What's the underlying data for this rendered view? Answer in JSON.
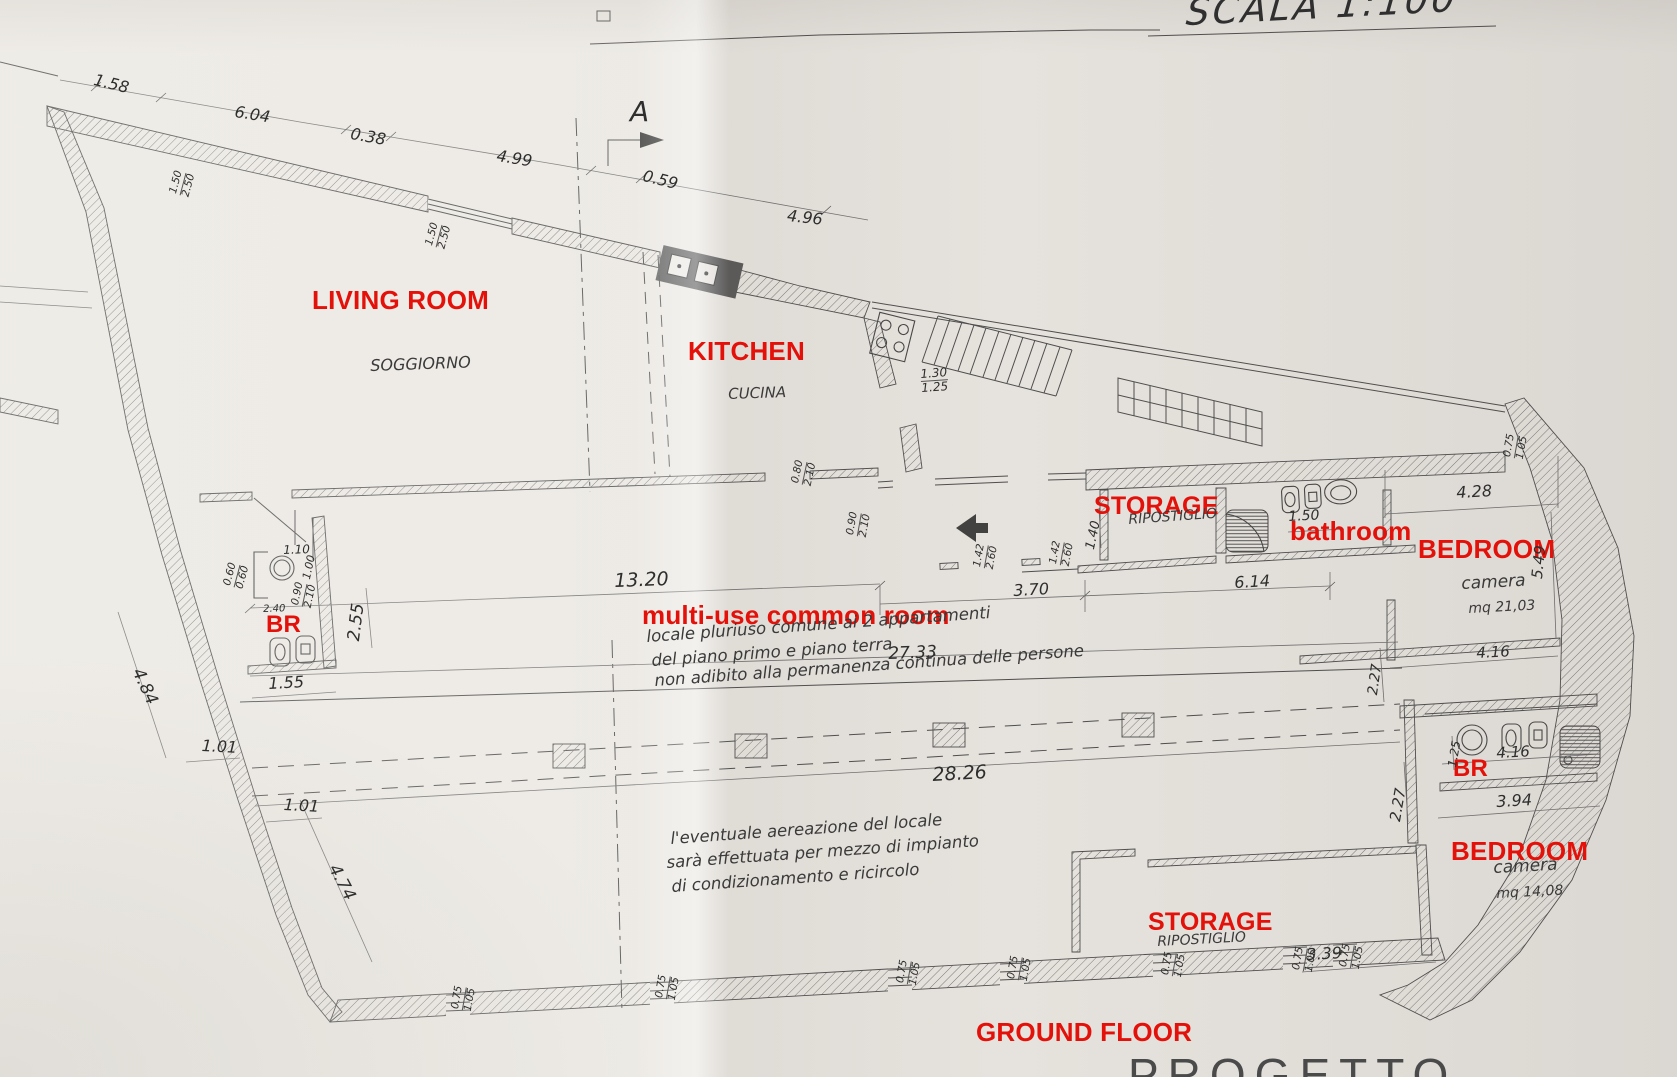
{
  "scale_note": "SCALA 1:100",
  "section_marker": "A",
  "floor_label": "GROUND FLOOR",
  "title_partial": "PROGETTO",
  "colors": {
    "annotation_red": "#e31109",
    "ink": "#3c3c3c",
    "paper": "#eae7e2"
  },
  "rooms": {
    "living_room_en": "LIVING ROOM",
    "living_room_it": "SOGGIORNO",
    "kitchen_en": "KITCHEN",
    "kitchen_it": "CUCINA",
    "storage_en": "STORAGE",
    "storage_it": "RIPOSTIGLIO",
    "bathroom_en": "bathroom",
    "bedroom_en": "BEDROOM",
    "bedroom1_it": "camera",
    "bedroom1_area": "mq 21,03",
    "bedroom2_it": "camera",
    "bedroom2_area": "mq 14,08",
    "br": "BR",
    "multi_use_en": "multi-use common room"
  },
  "notes": {
    "multi_use_1": "locale pluriuso comune ai 2 appartamenti",
    "multi_use_2": "del piano primo e piano terra",
    "multi_use_3": "non adibito alla permanenza continua delle persone",
    "aeration_1": "l'eventuale aereazione del locale",
    "aeration_2": "sarà effettuata per mezzo di impianto",
    "aeration_3": "di condizionamento e ricircolo"
  },
  "dims": {
    "top": [
      "1.58",
      "6.04",
      "0.38",
      "4.99",
      "0.59",
      "4.96"
    ],
    "mid": [
      "13.20",
      "3.70",
      "6.14",
      "27.33",
      "28.26"
    ],
    "right": [
      "4.28",
      "1.50",
      "5.49",
      "4.16",
      "2.27",
      "1.25",
      "4.16",
      "2.27",
      "3.94",
      "3.39",
      "1.40"
    ],
    "left": [
      "2.55",
      "1.10",
      "1.00",
      "2.40",
      "1.55",
      "4.84",
      "1.01",
      "1.01",
      "4.74"
    ],
    "window": [
      "0.75",
      "1.05"
    ],
    "door": [
      "1.42",
      "2.60"
    ],
    "door2": [
      "0.90",
      "2.10"
    ],
    "door3": [
      "0.80",
      "2.10"
    ],
    "win_top": [
      "1.50",
      "2.50"
    ],
    "sill": [
      "0.60",
      "0.60"
    ],
    "kitchen_pass": [
      "1.30",
      "1.25"
    ]
  }
}
